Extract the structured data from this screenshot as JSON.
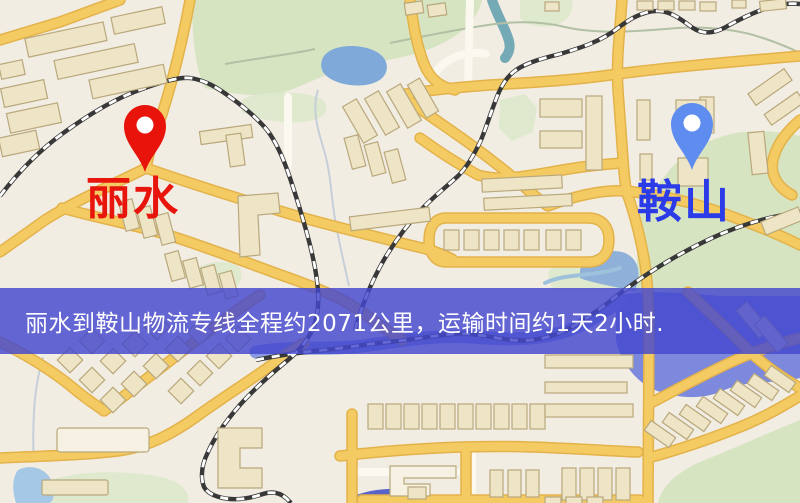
{
  "banner": {
    "text": "丽水到鞍山物流专线全程约2071公里，运输时间约1天2小时.",
    "background_color": "#4347CE",
    "text_color": "#FFFFFF"
  },
  "origin": {
    "name": "丽水",
    "pin_color": "#E8140C",
    "label_color": "#E8150D"
  },
  "destination": {
    "name": "鞍山",
    "pin_color": "#5F8DEF",
    "label_color": "#2B3BE8"
  },
  "route": {
    "distance": "约2071公里",
    "duration": "约1天2小时"
  },
  "map_palette": {
    "background": "#F2EDE3",
    "road": "#F4CB62",
    "park": "#D6E4C2",
    "water": "#7C89DC",
    "building": "#EEE4C6",
    "railway": "#383838"
  }
}
